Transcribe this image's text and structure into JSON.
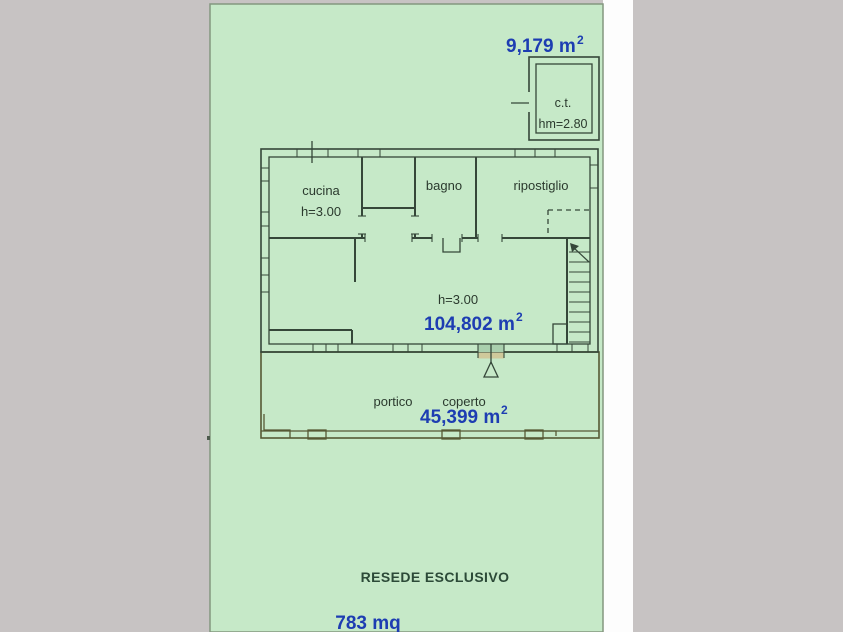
{
  "plan": {
    "land": {
      "area_label": {
        "value": "9,179 m",
        "sup": "2"
      },
      "resede_label": "RESEDE ESCLUSIVO",
      "resede_area": "783 mq"
    },
    "rooms": {
      "cucina": {
        "label": "cucina",
        "height": "h=3.00"
      },
      "bagno": {
        "label": "bagno"
      },
      "ripostiglio": {
        "label": "ripostiglio"
      },
      "ct": {
        "label": "c.t.",
        "height": "hm=2.80"
      },
      "living": {
        "height": "h=3.00",
        "area": {
          "value": "104,802 m",
          "sup": "2"
        }
      },
      "portico": {
        "label_1": "portico",
        "label_2": "coperto",
        "area": {
          "value": "45,399 m",
          "sup": "2"
        }
      }
    },
    "colors": {
      "background_gray": "#c7c3c3",
      "white_strip": "#fdfdfd",
      "land_green": "#c6e9c8",
      "land_border": "#84977f",
      "room_green": "#a9cfad",
      "portico_tan": "#cfc99b",
      "wall_dark": "#354739",
      "area_blue": "#1d3db2",
      "label_dark": "#2b3a2e"
    }
  }
}
